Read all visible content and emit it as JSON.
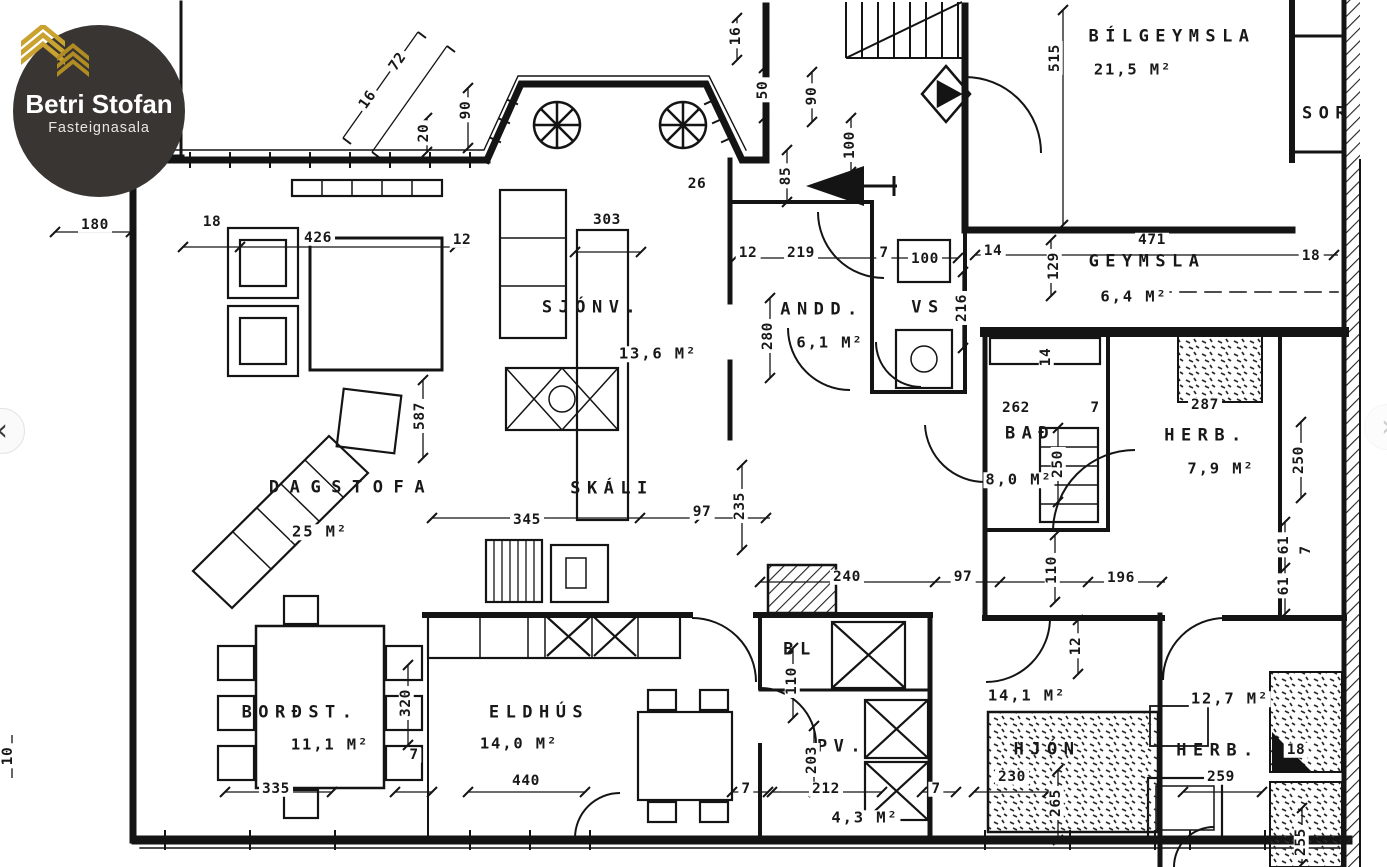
{
  "logo": {
    "title": "Betri Stofan",
    "subtitle": "Fasteignasala"
  },
  "carousel": {
    "prev": "‹",
    "next": "›"
  },
  "colors": {
    "logo_bg": "#393532",
    "logo_gold": "#c9a22f",
    "ink": "#181818",
    "paper": "#ffffff"
  },
  "rooms": [
    {
      "name": "BÍLGEYMSLA",
      "area": "21,5 M²"
    },
    {
      "name": "SOR"
    },
    {
      "name": "GEYMSLA",
      "area": "6,4 M²"
    },
    {
      "name": "SJÓNV.",
      "area": "13,6 M²"
    },
    {
      "name": "ANDD.",
      "area": "6,1 M²"
    },
    {
      "name": "VS"
    },
    {
      "name": "BAÐ",
      "area": "8,0 M²"
    },
    {
      "name": "HERB.",
      "area": "7,9 M²"
    },
    {
      "name": "DAGSTOFA",
      "area": "25 M²"
    },
    {
      "name": "SKÁLI"
    },
    {
      "name": "BORÐST.",
      "area": "11,1 M²"
    },
    {
      "name": "ELDHÚS",
      "area": "14,0 M²"
    },
    {
      "name": "BL"
    },
    {
      "name": "PV.",
      "area": "4,3 M²"
    },
    {
      "name": "HJÓN",
      "area": "14,1 M²"
    },
    {
      "name": "HERB.",
      "area": "12,7 M²"
    }
  ],
  "dims": [
    "180",
    "18",
    "426",
    "12",
    "16",
    "72",
    "20",
    "90",
    "16",
    "50",
    "90",
    "100",
    "85",
    "26",
    "303",
    "12",
    "219",
    "7",
    "100",
    "14",
    "129",
    "471",
    "18",
    "515",
    "280",
    "216",
    "262",
    "7",
    "287",
    "250",
    "250",
    "587",
    "345",
    "97",
    "235",
    "240",
    "97",
    "110",
    "196",
    "61",
    "61",
    "7",
    "12",
    "110",
    "320",
    "7",
    "335",
    "440",
    "203",
    "212",
    "7",
    "7",
    "230",
    "265",
    "259",
    "18",
    "255",
    "10",
    "14"
  ]
}
